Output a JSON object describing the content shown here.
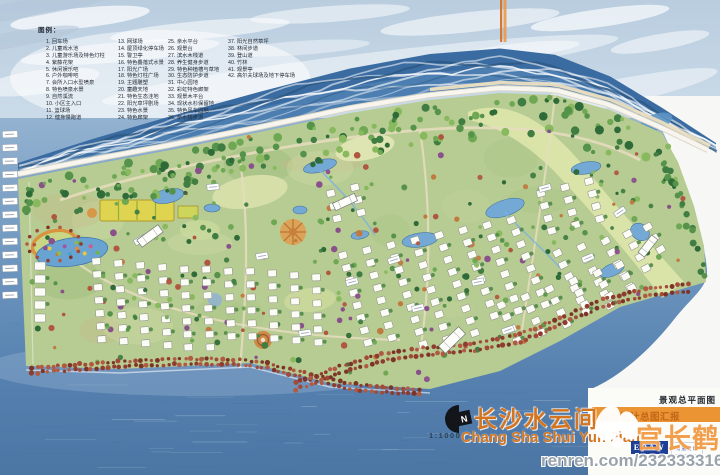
{
  "legend": {
    "title": "图例：",
    "columns": [
      {
        "items": [
          "1. 回车场",
          "2. 儿童戏水池",
          "3. 儿童游乐场及特色灯柱",
          "4. 紫藤花架",
          "5. 休闲娱乐吧",
          "6. 户外咖啡吧",
          "7. 会所入口水型喷泉",
          "8. 特色喷泉水景",
          "9. 自然溪流",
          "10. 小区主入口",
          "11. 篮球场",
          "12. 健身慢跑道"
        ]
      },
      {
        "items": [
          "13. 网球场",
          "14. 屋顶绿化停车场",
          "15. 警卫亭",
          "16. 特色叠落式水景",
          "17. 阳光广场",
          "18. 特色灯柱广场",
          "19. 主题雕塑",
          "20. 童趣天地",
          "21. 特色生态洼地",
          "22. 阳光草坪剧场",
          "23. 特色水景",
          "24. 特色廊架"
        ]
      },
      {
        "items": [
          "25. 亲水平台",
          "26. 观景台",
          "27. 滨水木栈道",
          "28. 养生健身步道",
          "29. 特色种植槽与草地",
          "30. 生态防护步道",
          "31. 中心园地",
          "32. 彩虹特色廊架",
          "33. 观景木平台",
          "34. 现状水杉保留地",
          "35. 特色风车园地",
          "36. 亲水栈步道"
        ]
      },
      {
        "items": [
          "37. 阳光自然草坪",
          "38. 林间步道",
          "39. 登山道",
          "40. 竹林",
          "41. 观景亭",
          "42. 高尔夫球场及地下停车场"
        ]
      }
    ]
  },
  "titleblock": {
    "drawing_type": "景观总平面图",
    "banner": "景观设计总图汇报",
    "project_title_cn": "长沙水云间",
    "project_title_en": "Chang Sha Shui Yun Jian",
    "scale": "1:1000",
    "north_label": "N",
    "logo_text": "EDAW",
    "logo_sub": "易道设计"
  },
  "watermark": {
    "name": "宫长鹤",
    "site": "renren.com/232333316"
  },
  "colors": {
    "accent_orange": "#d4741e",
    "banner_orange": "#ea9433",
    "water_blue": "#5f8cba",
    "site_green": "#b7cc92",
    "road_tree_red": "#8f3c30",
    "court_yellow": "#dfd44f",
    "logo_blue": "#1e3f96"
  }
}
